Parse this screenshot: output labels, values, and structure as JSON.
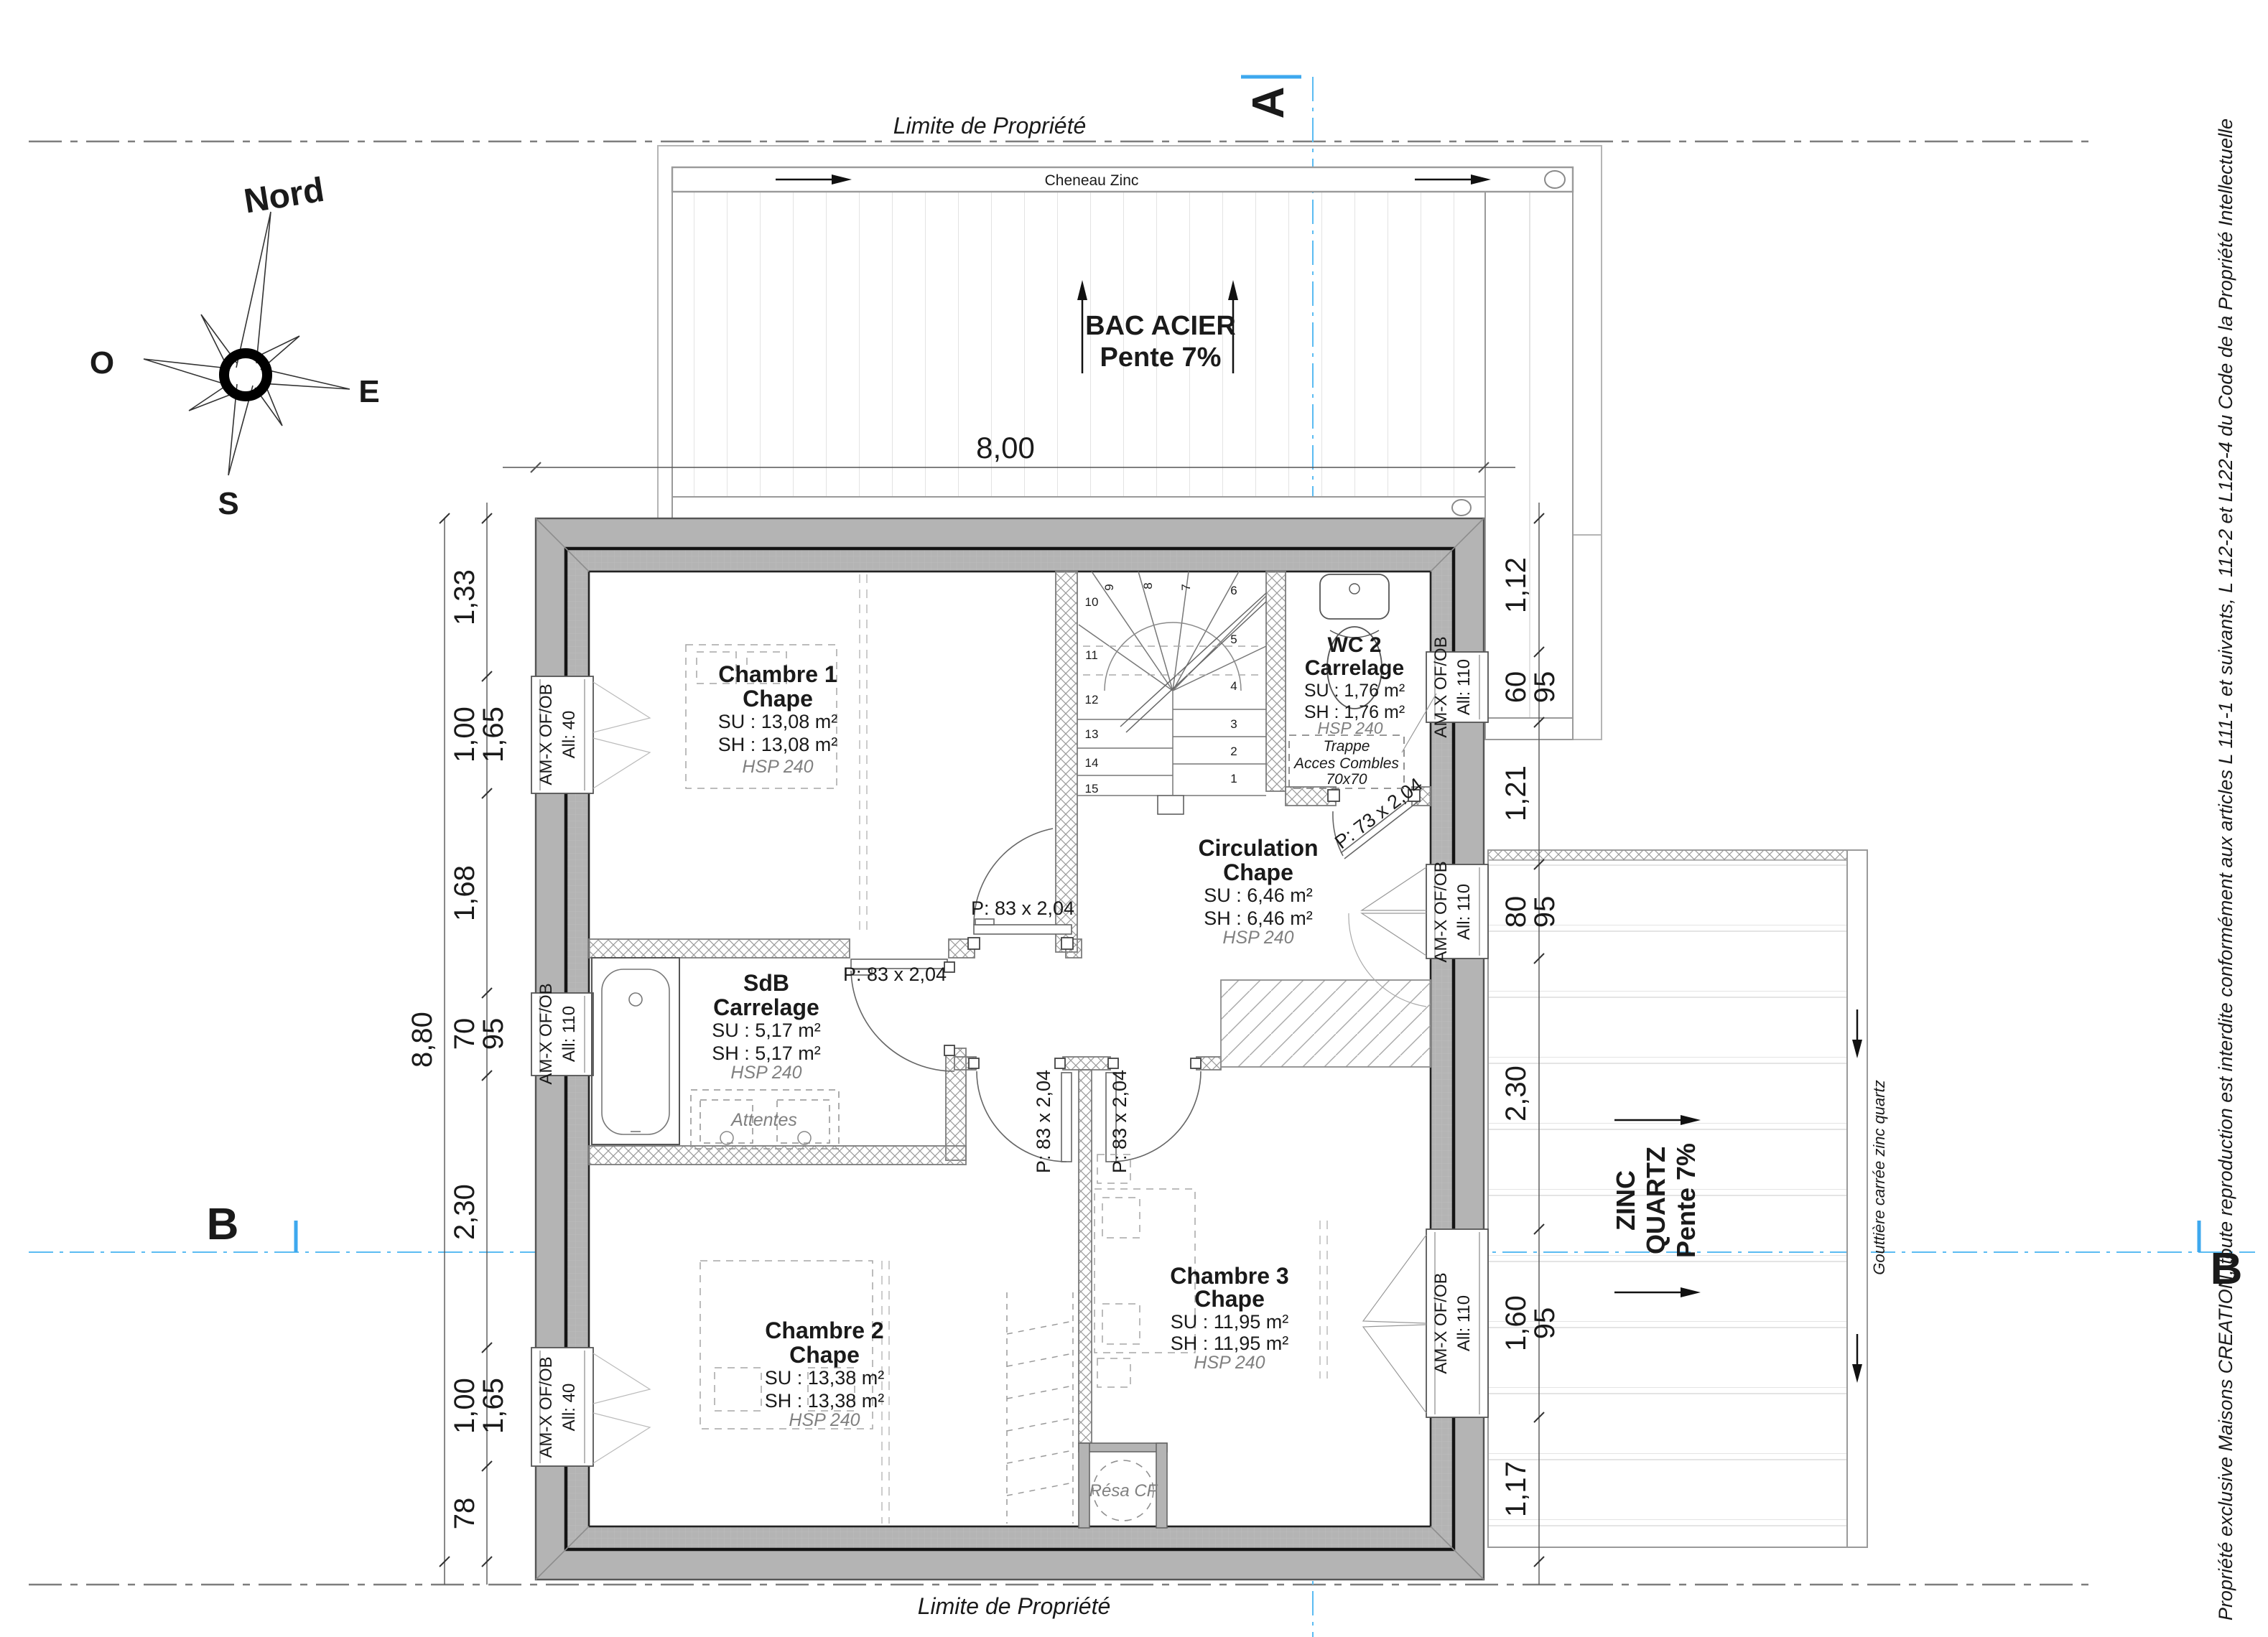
{
  "compass": {
    "north": "Nord",
    "west": "O",
    "east": "E",
    "south": "S"
  },
  "property": {
    "top": "Limite de Propriété",
    "bottom": "Limite de Propriété"
  },
  "sections": {
    "a": "A",
    "b_left": "B",
    "b_right": "B"
  },
  "roof_top": {
    "gutter_label": "Cheneau Zinc",
    "material": "BAC ACIER",
    "slope": "Pente 7%",
    "width_dim": "8,00"
  },
  "roof_right": {
    "l1": "ZINC",
    "l2": "QUARTZ",
    "l3": "Pente 7%",
    "gutter_note": "Gouttière carrée zinc quartz"
  },
  "rooms": [
    {
      "name": "Chambre 1",
      "finish": "Chape",
      "su": "SU : 13,08 m²",
      "sh": "SH : 13,08 m²",
      "hsp": "HSP 240"
    },
    {
      "name": "WC 2",
      "finish": "Carrelage",
      "su": "SU : 1,76 m²",
      "sh": "SH : 1,76 m²",
      "hsp": "HSP 240"
    },
    {
      "name": "Circulation",
      "finish": "Chape",
      "su": "SU : 6,46 m²",
      "sh": "SH : 6,46 m²",
      "hsp": "HSP 240"
    },
    {
      "name": "SdB",
      "finish": "Carrelage",
      "su": "SU : 5,17 m²",
      "sh": "SH : 5,17 m²",
      "hsp": "HSP 240"
    },
    {
      "name": "Chambre 2",
      "finish": "Chape",
      "su": "SU : 13,38 m²",
      "sh": "SH : 13,38 m²",
      "hsp": "HSP 240"
    },
    {
      "name": "Chambre 3",
      "finish": "Chape",
      "su": "SU : 11,95 m²",
      "sh": "SH : 11,95 m²",
      "hsp": "HSP 240"
    }
  ],
  "trappe": {
    "l1": "Trappe",
    "l2": "Acces Combles",
    "l3": "70x70"
  },
  "doors": {
    "p83": "P: 83 x 2,04",
    "p73": "P: 73 x 2,04"
  },
  "windows": {
    "brand": "AM-X OF/OB",
    "all40": "All: 40",
    "all110": "All: 110"
  },
  "annotations": {
    "attentes": "Attentes",
    "resa": "Résa CF"
  },
  "dims_left": {
    "d1": "1,33",
    "d2": "1,00",
    "d2b": "1,65",
    "d3": "1,68",
    "d4": "70",
    "d4b": "95",
    "d5": "2,30",
    "d6": "1,00",
    "d6b": "1,65",
    "d7": "78",
    "total": "8,80"
  },
  "dims_right": {
    "d1": "1,12",
    "d2": "60",
    "d2b": "95",
    "d3": "1,21",
    "d4": "80",
    "d4b": "95",
    "d5": "2,30",
    "d6": "1,60",
    "d6b": "95",
    "d7": "1,17"
  },
  "stairs": [
    "1",
    "2",
    "3",
    "4",
    "5",
    "6",
    "7",
    "8",
    "9",
    "10",
    "11",
    "12",
    "13",
    "14",
    "15"
  ],
  "copyright": "Propriété exclusive Maisons CREATION, toute reproduction est interdite conformément aux articles L 111-1 et suivants, L 112-2 et L122-4 du Code de la Propriété Intellectuelle",
  "colors": {
    "section_line": "#5bbcf2",
    "wall_fill": "#b4b4b4",
    "line_gray": "#808080"
  }
}
